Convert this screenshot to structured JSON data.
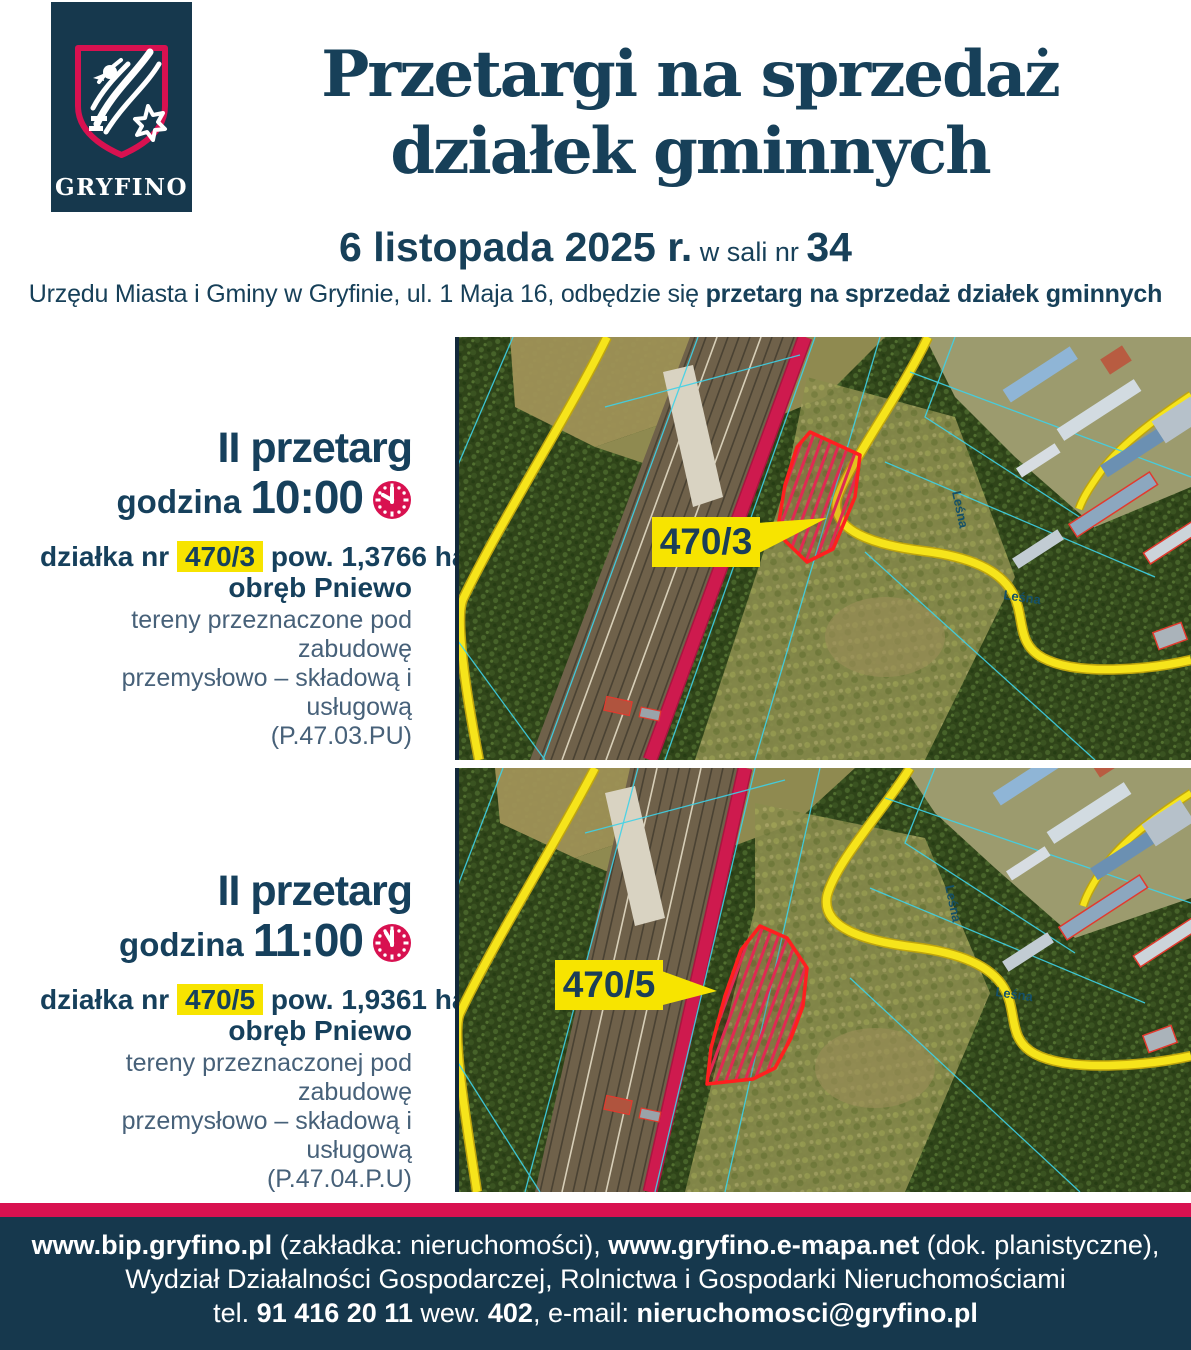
{
  "colors": {
    "navy_bg": "#16384d",
    "navy_text": "#174059",
    "crimson": "#d81150",
    "highlight_yellow": "#f7e400",
    "cadastral_cyan": "#3ed2e8"
  },
  "logo": {
    "wordmark": "GRYFINO"
  },
  "header": {
    "title_line1": "Przetargi na sprzedaż",
    "title_line2": "działek gminnych",
    "date_bold": "6 listopada 2025 r.",
    "date_mid": " w sali nr ",
    "date_room": "34",
    "subtitle_regular": "Urzędu Miasta i Gminy w Gryfinie, ul. 1 Maja 16, odbędzie się ",
    "subtitle_bold": "przetarg na sprzedaż działek gminnych"
  },
  "sections": [
    {
      "heading": "II przetarg",
      "time_label": "godzina ",
      "time": "10:00",
      "clock_icon": "analog-clock-10-00",
      "plot_label": "działka nr",
      "plot_number": "470/3",
      "area": "pow. 1,3766 ha",
      "district_label": "obręb ",
      "district_name": "Pniewo",
      "desc_line1": "tereny przeznaczone pod zabudowę",
      "desc_line2": "przemysłowo – składową i usługową",
      "desc_line3": "(P.47.03.PU)",
      "map_label": "470/3",
      "street_label": "Leśna"
    },
    {
      "heading": "II przetarg",
      "time_label": "godzina ",
      "time": "11:00",
      "clock_icon": "analog-clock-11-00",
      "plot_label": "działka nr",
      "plot_number": "470/5",
      "area": "pow. 1,9361 ha",
      "district_label": "obręb ",
      "district_name": "Pniewo",
      "desc_line1": "tereny przeznaczonej pod zabudowę",
      "desc_line2": "przemysłowo – składową i usługową",
      "desc_line3": "(P.47.04.P.U)",
      "map_label": "470/5",
      "street_label": "Leśna"
    }
  ],
  "footer": {
    "line1_bold1": "www.bip.gryfino.pl",
    "line1_reg1": " (zakładka: nieruchomości), ",
    "line1_bold2": "www.gryfino.e-mapa.net",
    "line1_reg2": " (dok. planistyczne),",
    "line2": "Wydział Działalności Gospodarczej, Rolnictwa i Gospodarki Nieruchomościami",
    "line3_reg1": "tel. ",
    "line3_bold1": "91 416 20 11",
    "line3_reg2": " wew. ",
    "line3_bold2": "402",
    "line3_reg3": ", e-mail: ",
    "line3_bold3": "nieruchomosci@gryfino.pl"
  }
}
